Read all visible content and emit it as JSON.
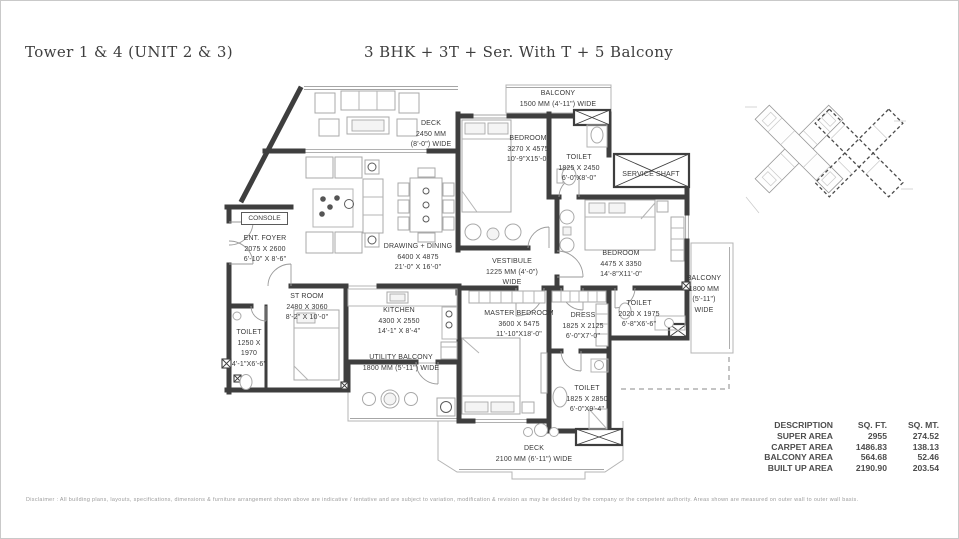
{
  "header": {
    "left_title": "Tower 1 & 4 (UNIT 2 & 3)",
    "center_title": "3 BHK + 3T + Ser. With T + 5 Balcony"
  },
  "rooms": {
    "deck_top": {
      "l1": "DECK",
      "l2": "2450 MM",
      "l3": "(8'-0\") WIDE"
    },
    "balcony_top": {
      "l1": "BALCONY",
      "l2": "1500 MM (4'-11\") WIDE"
    },
    "bedroom_top": {
      "l1": "BEDROOM",
      "l2": "3270 X 4575",
      "l3": "10'-9\"X15'-0\""
    },
    "toilet_top": {
      "l1": "TOILET",
      "l2": "1825 X 2450",
      "l3": "6'-0\"X8'-0\""
    },
    "service_shaft": {
      "l1": "SERVICE SHAFT"
    },
    "console": {
      "l1": "CONSOLE"
    },
    "ent_foyer": {
      "l1": "ENT. FOYER",
      "l2": "2075 X 2600",
      "l3": "6'-10\" X 8'-6\""
    },
    "drawing_dining": {
      "l1": "DRAWING + DINING",
      "l2": "6400 X 4875",
      "l3": "21'-0\" X 16'-0\""
    },
    "vestibule": {
      "l1": "VESTIBULE",
      "l2": "1225 MM (4'-0\")",
      "l3": "WIDE"
    },
    "bedroom_right": {
      "l1": "BEDROOM",
      "l2": "4475 X 3350",
      "l3": "14'-8\"X11'-0\""
    },
    "balcony_right": {
      "l1": "BALCONY",
      "l2": "1800 MM",
      "l3": "(5'-11\")",
      "l4": "WIDE"
    },
    "st_room": {
      "l1": "ST ROOM",
      "l2": "2480 X 3060",
      "l3": "8'-2\" X 10'-0\""
    },
    "kitchen": {
      "l1": "KITCHEN",
      "l2": "4300 X 2550",
      "l3": "14'-1\" X 8'-4\""
    },
    "toilet_left": {
      "l1": "TOILET",
      "l2": "1250 X",
      "l3": "1970",
      "l4": "4'-1\"X6'-6\""
    },
    "utility_balcony": {
      "l1": "UTILITY BALCONY",
      "l2": "1800 MM (5'-11\") WIDE"
    },
    "master_bedroom": {
      "l1": "MASTER BEDROOM",
      "l2": "3600 X 5475",
      "l3": "11'-10\"X18'-0\""
    },
    "dress": {
      "l1": "DRESS",
      "l2": "1825 X 2125",
      "l3": "6'-0\"X7'-0\""
    },
    "toilet_mid": {
      "l1": "TOILET",
      "l2": "2020 X 1975",
      "l3": "6'-8\"X6'-6\""
    },
    "toilet_bottom": {
      "l1": "TOILET",
      "l2": "1825 X 2850",
      "l3": "6'-0\"X9'-4\""
    },
    "deck_bottom": {
      "l1": "DECK",
      "l2": "2100 MM (6'-11\") WIDE"
    }
  },
  "area_table": {
    "headers": [
      "DESCRIPTION",
      "SQ. FT.",
      "SQ. MT."
    ],
    "rows": [
      {
        "label": "SUPER AREA",
        "sqft": "2955",
        "sqmt": "274.52"
      },
      {
        "label": "CARPET AREA",
        "sqft": "1486.83",
        "sqmt": "138.13"
      },
      {
        "label": "BALCONY AREA",
        "sqft": "564.68",
        "sqmt": "52.46"
      },
      {
        "label": "BUILT UP AREA",
        "sqft": "2190.90",
        "sqmt": "203.54"
      }
    ]
  },
  "footer": {
    "disclaimer": "Disclaimer : All building plans, layouts, specifications, dimensions & furniture arrangement shown above are indicative / tentative and are subject to variation, modification & revision as may be decided by the company or the competent authority. Areas shown are measured on outer wall to outer wall basis."
  },
  "colors": {
    "wall": "#3e3e3e",
    "outline": "#b4b4b4",
    "text": "#393939",
    "muted": "#9b9b9b"
  }
}
